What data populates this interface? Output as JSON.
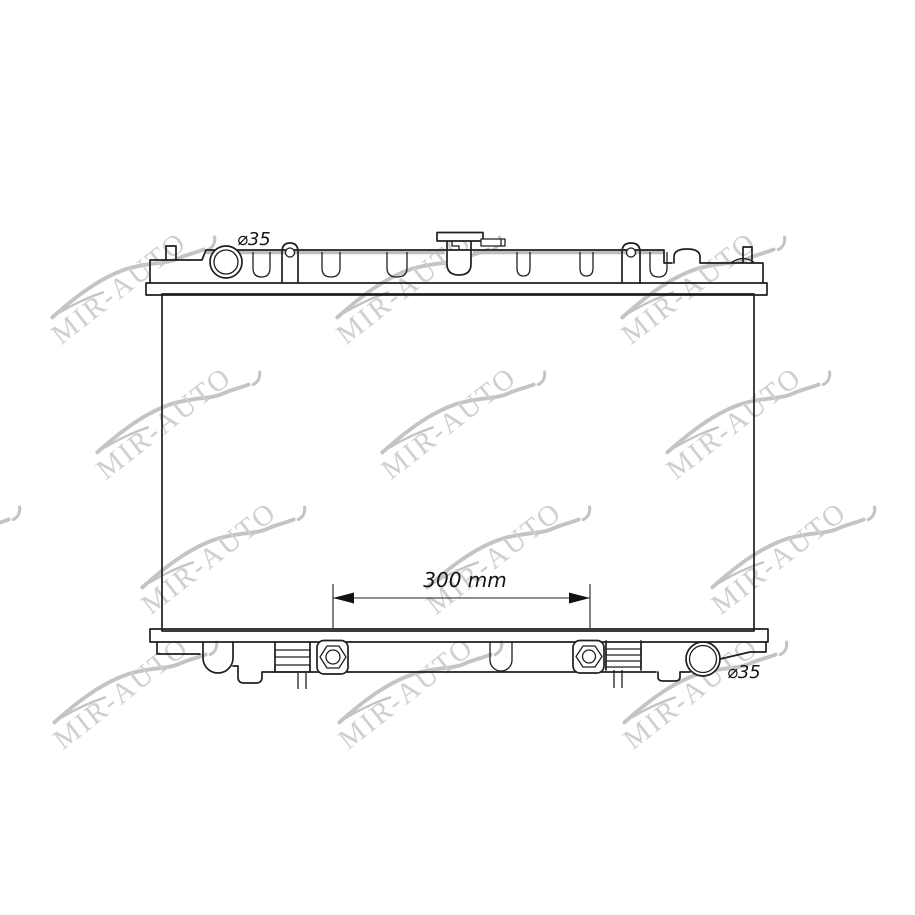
{
  "watermark": {
    "text": "MIR-AUTO",
    "text_color": "#cfcfcf",
    "swoosh_color": "#c4c4c4"
  },
  "drawing": {
    "background": "#ffffff",
    "line_color": "#1f1f1f",
    "port_fill": "#b3b3b3",
    "fitting_fill": "#a0a0a0",
    "labels": {
      "inlet_diameter": "⌀35",
      "outlet_diameter": "⌀35",
      "mount_distance": "300 mm"
    }
  }
}
